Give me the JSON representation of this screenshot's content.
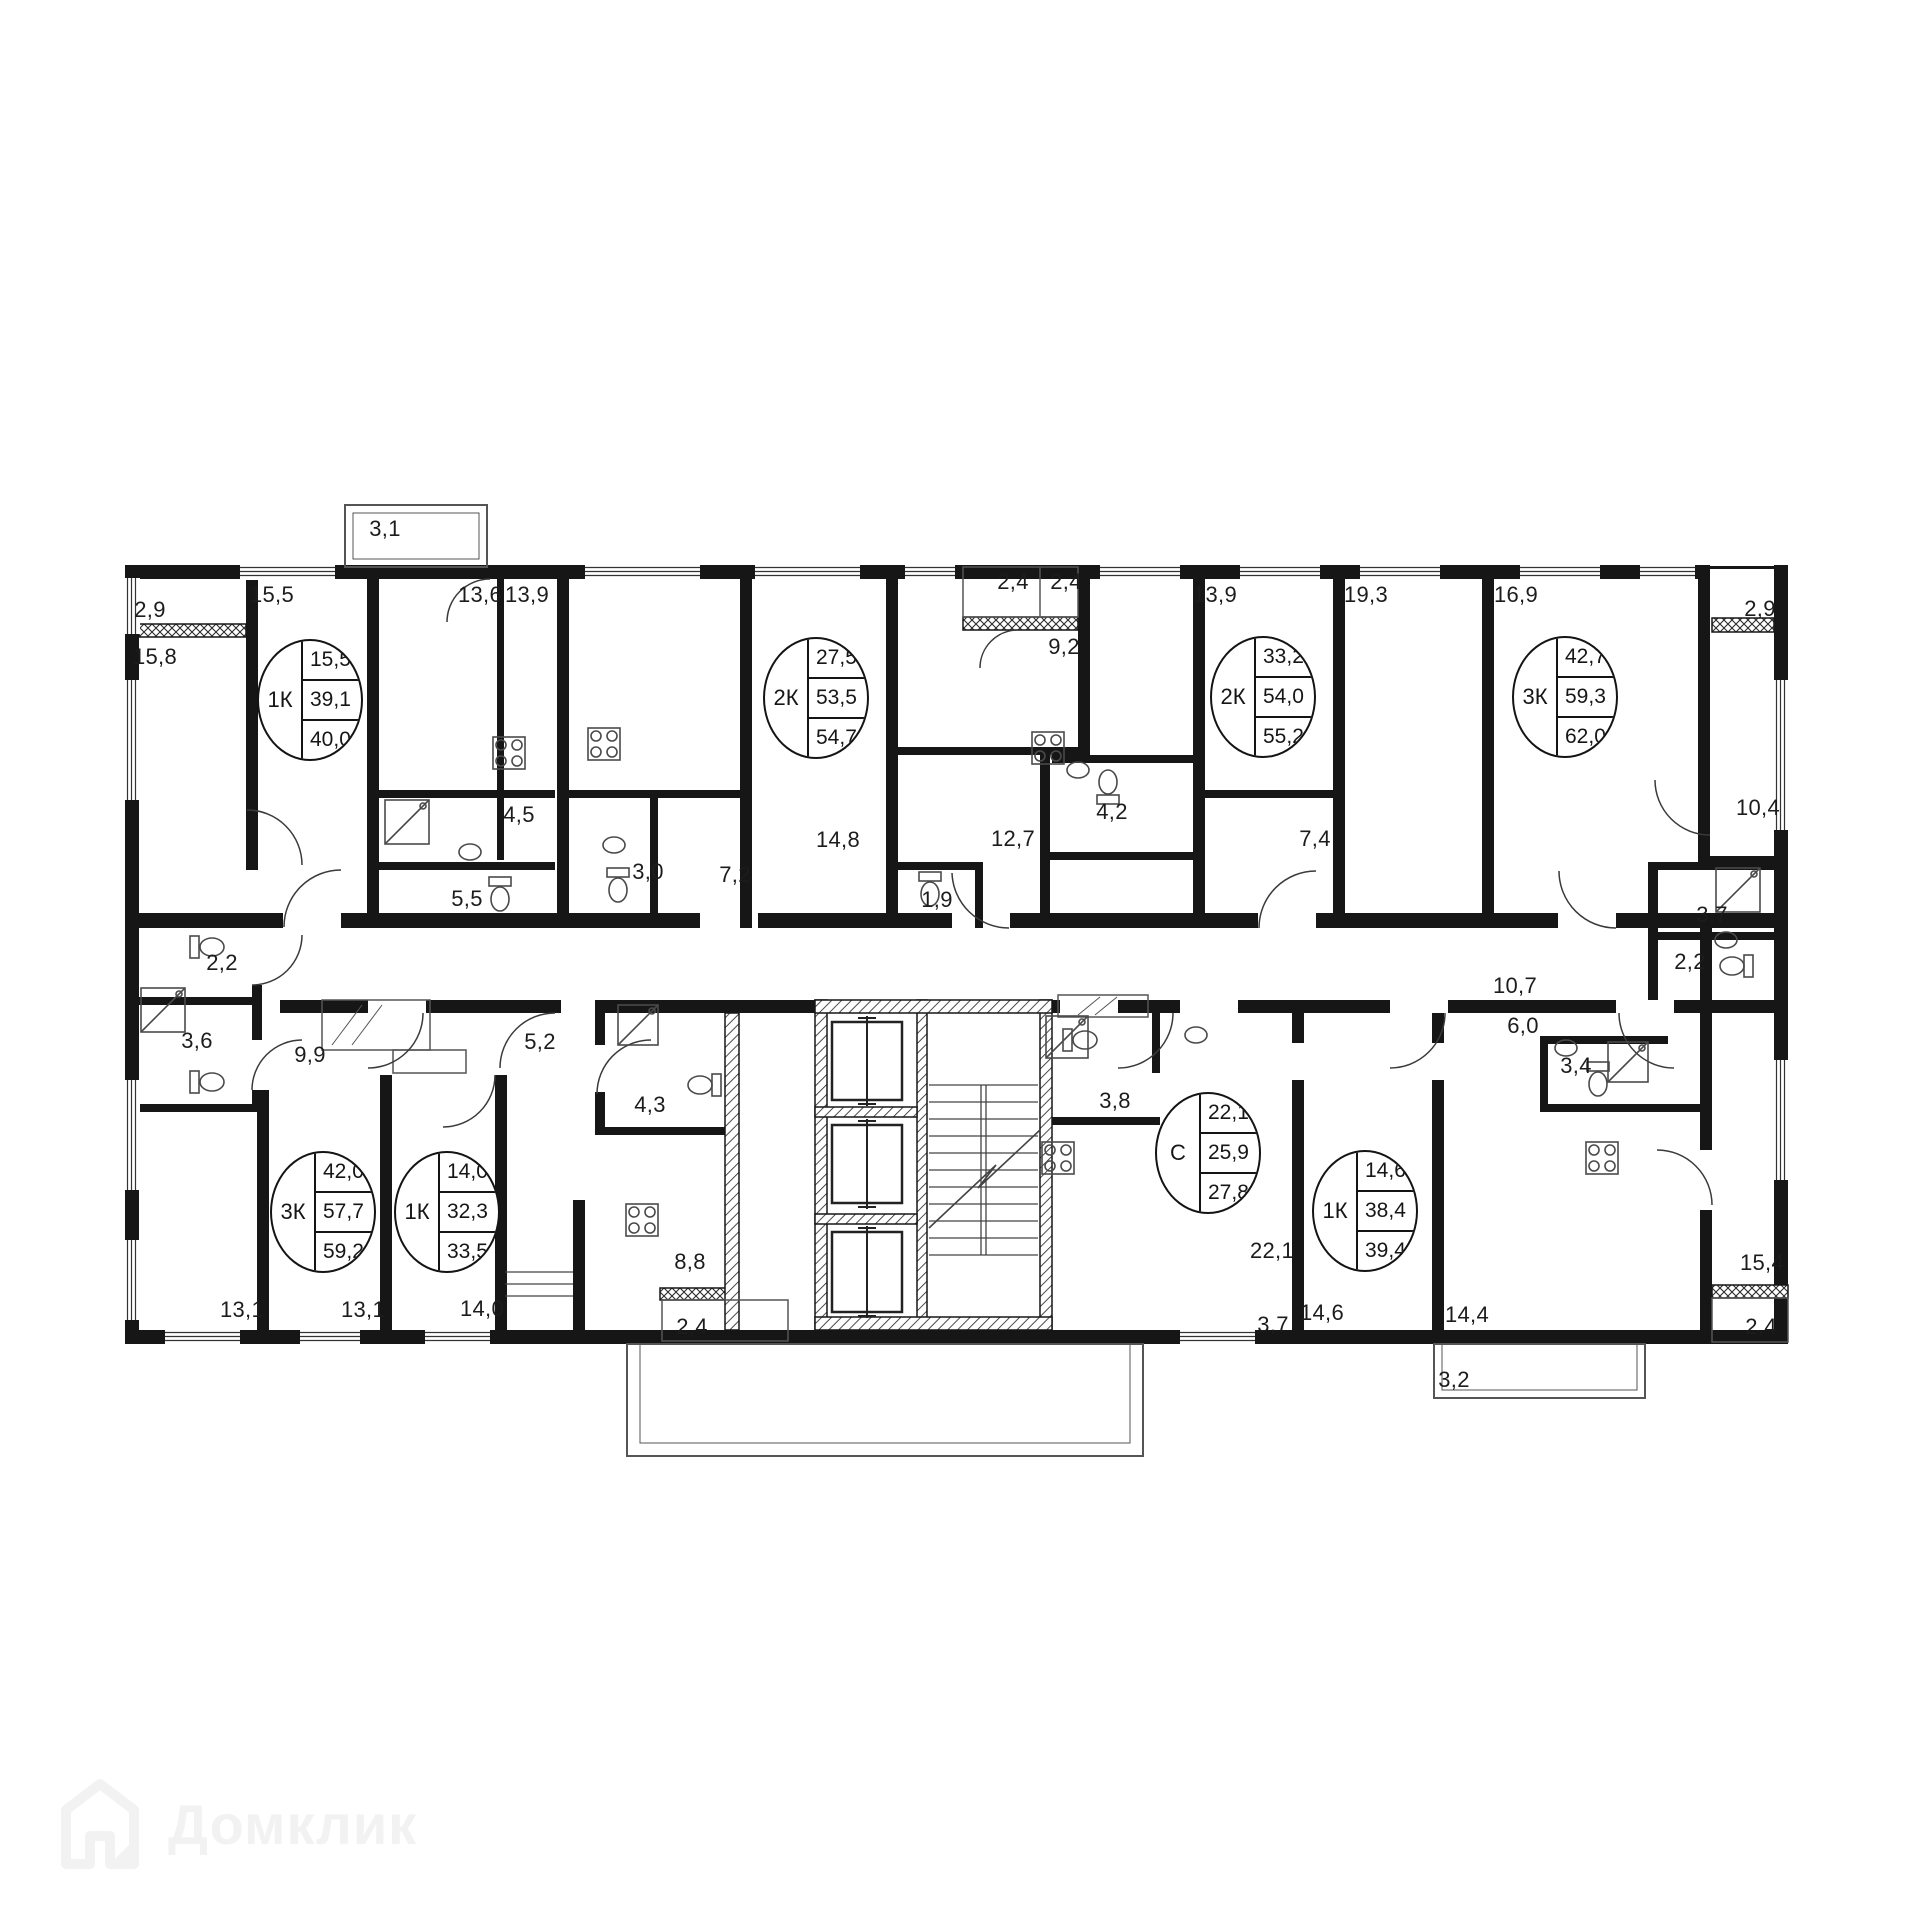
{
  "watermark": {
    "text": "Домклик"
  },
  "plan": {
    "ink": "#161616",
    "area_labels": [
      {
        "t": "2,9",
        "x": 150,
        "y": 610
      },
      {
        "t": "15,8",
        "x": 155,
        "y": 657
      },
      {
        "t": "15,5",
        "x": 272,
        "y": 595
      },
      {
        "t": "3,1",
        "x": 385,
        "y": 529
      },
      {
        "t": "13,6",
        "x": 480,
        "y": 595
      },
      {
        "t": "13,9",
        "x": 527,
        "y": 595
      },
      {
        "t": "2,4",
        "x": 1013,
        "y": 582
      },
      {
        "t": "2,4",
        "x": 1066,
        "y": 582
      },
      {
        "t": "9,2",
        "x": 1064,
        "y": 647
      },
      {
        "t": "13,9",
        "x": 1215,
        "y": 595
      },
      {
        "t": "19,3",
        "x": 1366,
        "y": 595
      },
      {
        "t": "16,9",
        "x": 1516,
        "y": 595
      },
      {
        "t": "2,9",
        "x": 1760,
        "y": 609
      },
      {
        "t": "4,5",
        "x": 519,
        "y": 815
      },
      {
        "t": "5,5",
        "x": 467,
        "y": 899
      },
      {
        "t": "3,0",
        "x": 648,
        "y": 872
      },
      {
        "t": "7,2",
        "x": 735,
        "y": 875
      },
      {
        "t": "14,8",
        "x": 838,
        "y": 840
      },
      {
        "t": "12,7",
        "x": 1013,
        "y": 839
      },
      {
        "t": "1,9",
        "x": 937,
        "y": 900
      },
      {
        "t": "4,2",
        "x": 1112,
        "y": 812
      },
      {
        "t": "7,4",
        "x": 1315,
        "y": 839
      },
      {
        "t": "10,4",
        "x": 1758,
        "y": 808
      },
      {
        "t": "3,7",
        "x": 1712,
        "y": 915
      },
      {
        "t": "2,2",
        "x": 1690,
        "y": 962
      },
      {
        "t": "2,2",
        "x": 222,
        "y": 963
      },
      {
        "t": "3,6",
        "x": 197,
        "y": 1041
      },
      {
        "t": "9,9",
        "x": 310,
        "y": 1055
      },
      {
        "t": "5,2",
        "x": 540,
        "y": 1042
      },
      {
        "t": "4,3",
        "x": 650,
        "y": 1105
      },
      {
        "t": "10,7",
        "x": 1515,
        "y": 986
      },
      {
        "t": "6,0",
        "x": 1523,
        "y": 1026
      },
      {
        "t": "3,4",
        "x": 1576,
        "y": 1066
      },
      {
        "t": "3,8",
        "x": 1115,
        "y": 1101
      },
      {
        "t": "13,1",
        "x": 242,
        "y": 1310
      },
      {
        "t": "13,1",
        "x": 363,
        "y": 1310
      },
      {
        "t": "14,0",
        "x": 482,
        "y": 1309
      },
      {
        "t": "8,8",
        "x": 690,
        "y": 1262
      },
      {
        "t": "2,4",
        "x": 692,
        "y": 1327
      },
      {
        "t": "22,1",
        "x": 1272,
        "y": 1251
      },
      {
        "t": "3,7",
        "x": 1273,
        "y": 1325
      },
      {
        "t": "14,6",
        "x": 1322,
        "y": 1313
      },
      {
        "t": "14,4",
        "x": 1467,
        "y": 1315
      },
      {
        "t": "3,2",
        "x": 1454,
        "y": 1380
      },
      {
        "t": "15,4",
        "x": 1762,
        "y": 1263
      },
      {
        "t": "2,4",
        "x": 1761,
        "y": 1327
      }
    ],
    "apartments": [
      {
        "type": "1К",
        "values": [
          "15,5",
          "39,1",
          "40,0"
        ],
        "x": 310,
        "y": 700
      },
      {
        "type": "2К",
        "values": [
          "27,5",
          "53,5",
          "54,7"
        ],
        "x": 816,
        "y": 698
      },
      {
        "type": "2К",
        "values": [
          "33,2",
          "54,0",
          "55,2"
        ],
        "x": 1263,
        "y": 697
      },
      {
        "type": "3К",
        "values": [
          "42,7",
          "59,3",
          "62,0"
        ],
        "x": 1565,
        "y": 697
      },
      {
        "type": "3К",
        "values": [
          "42,0",
          "57,7",
          "59,2"
        ],
        "x": 323,
        "y": 1212
      },
      {
        "type": "1К",
        "values": [
          "14,0",
          "32,3",
          "33,5"
        ],
        "x": 447,
        "y": 1212
      },
      {
        "type": "С",
        "values": [
          "22,1",
          "25,9",
          "27,8"
        ],
        "x": 1208,
        "y": 1153
      },
      {
        "type": "1К",
        "values": [
          "14,6",
          "38,4",
          "39,4"
        ],
        "x": 1365,
        "y": 1211
      }
    ]
  }
}
